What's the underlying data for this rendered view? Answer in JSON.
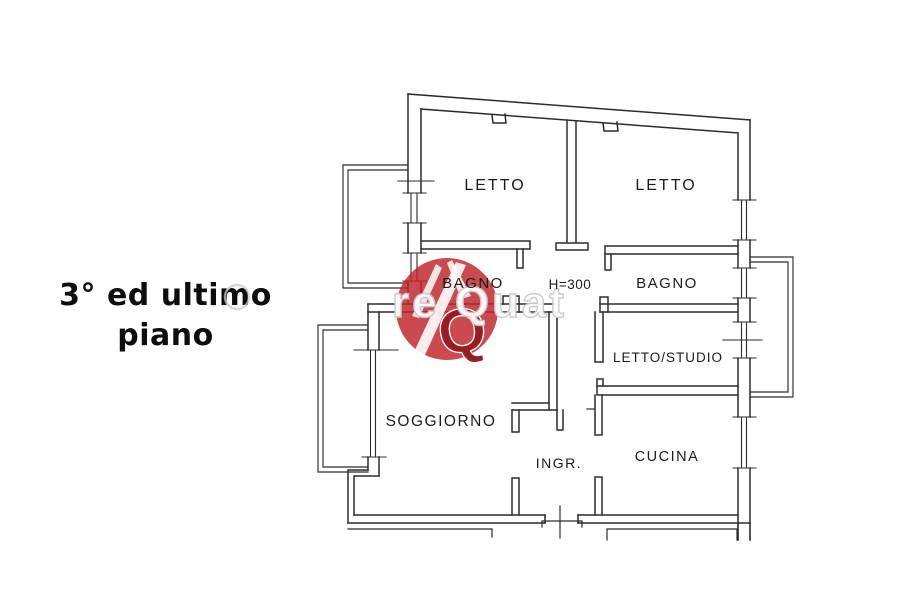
{
  "caption": {
    "line1": "3° ed ultimo",
    "line2": "piano"
  },
  "plan": {
    "height_annotation": "H=300",
    "rooms": [
      {
        "id": "letto-1",
        "label": "LETTO"
      },
      {
        "id": "letto-2",
        "label": "LETTO"
      },
      {
        "id": "bagno-1",
        "label": "BAGNO"
      },
      {
        "id": "bagno-2",
        "label": "BAGNO"
      },
      {
        "id": "letto-studio",
        "label": "LETTO/STUDIO"
      },
      {
        "id": "soggiorno",
        "label": "SOGGIORNO"
      },
      {
        "id": "ingresso",
        "label": "INGR."
      },
      {
        "id": "cucina",
        "label": "CUCINA"
      }
    ]
  },
  "watermark": {
    "text_fragment": "re Quat",
    "monogram": "Q",
    "brand_color": "#c0272d"
  },
  "colors": {
    "wall": "#2b2b2b",
    "label": "#1c1c1c",
    "caption": "#0d0d0d",
    "watermark_gray": "#c9c9c9"
  }
}
